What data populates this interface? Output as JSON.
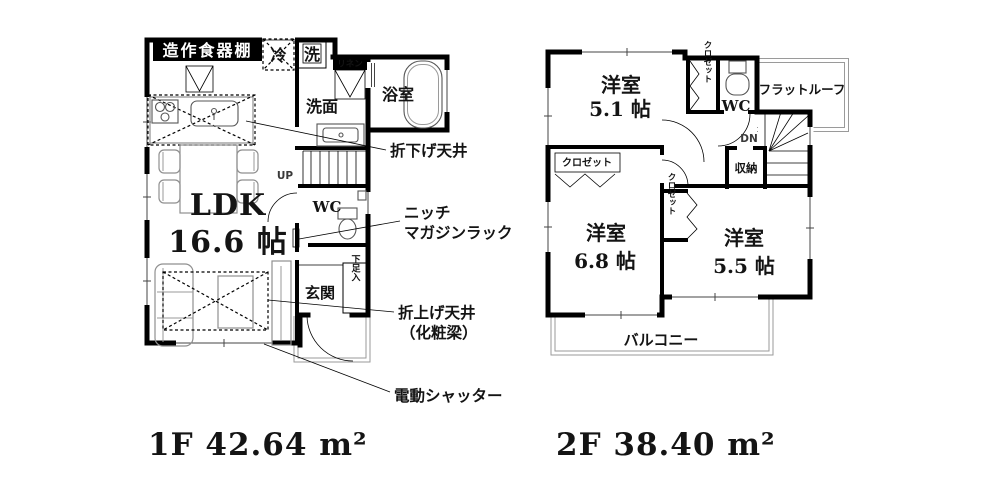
{
  "colors": {
    "wall": "#000000",
    "text": "#141414",
    "furniture": "#8f8f8f"
  },
  "floor1": {
    "title": "1F 42.64 m²",
    "rooms": {
      "ldk": {
        "name": "LDK",
        "size": "16.6 帖"
      },
      "washroom": {
        "name": "洗面"
      },
      "bathroom": {
        "name": "浴室"
      },
      "wc": {
        "name": "WC"
      },
      "entrance": {
        "name": "玄関"
      }
    },
    "fixtures": {
      "cupboard": "造作食器棚",
      "fridge": "冷",
      "washer": "洗",
      "linen": "リネン",
      "shoe_cabinet": "下足入",
      "stairs": "UP"
    },
    "annotations": {
      "lowered_ceiling": "折下げ天井",
      "niche_line1": "ニッチ",
      "niche_line2": "マガジンラック",
      "raised_ceiling_line1": "折上げ天井",
      "raised_ceiling_line2": "（化粧梁）",
      "electric_shutter": "電動シャッター"
    }
  },
  "floor2": {
    "title": "2F 38.40 m²",
    "rooms": {
      "bedroom_a": {
        "name": "洋室",
        "size": "5.1 帖"
      },
      "bedroom_b": {
        "name": "洋室",
        "size": "6.8 帖"
      },
      "bedroom_c": {
        "name": "洋室",
        "size": "5.5 帖"
      },
      "wc": {
        "name": "WC"
      }
    },
    "fixtures": {
      "closet_a": "クロゼット",
      "closet_b": "クロゼット",
      "closet_c": "クロゼット",
      "storage": "収納",
      "stairs": "DN",
      "flat_roof": "フラットルーフ",
      "balcony": "バルコニー"
    }
  }
}
